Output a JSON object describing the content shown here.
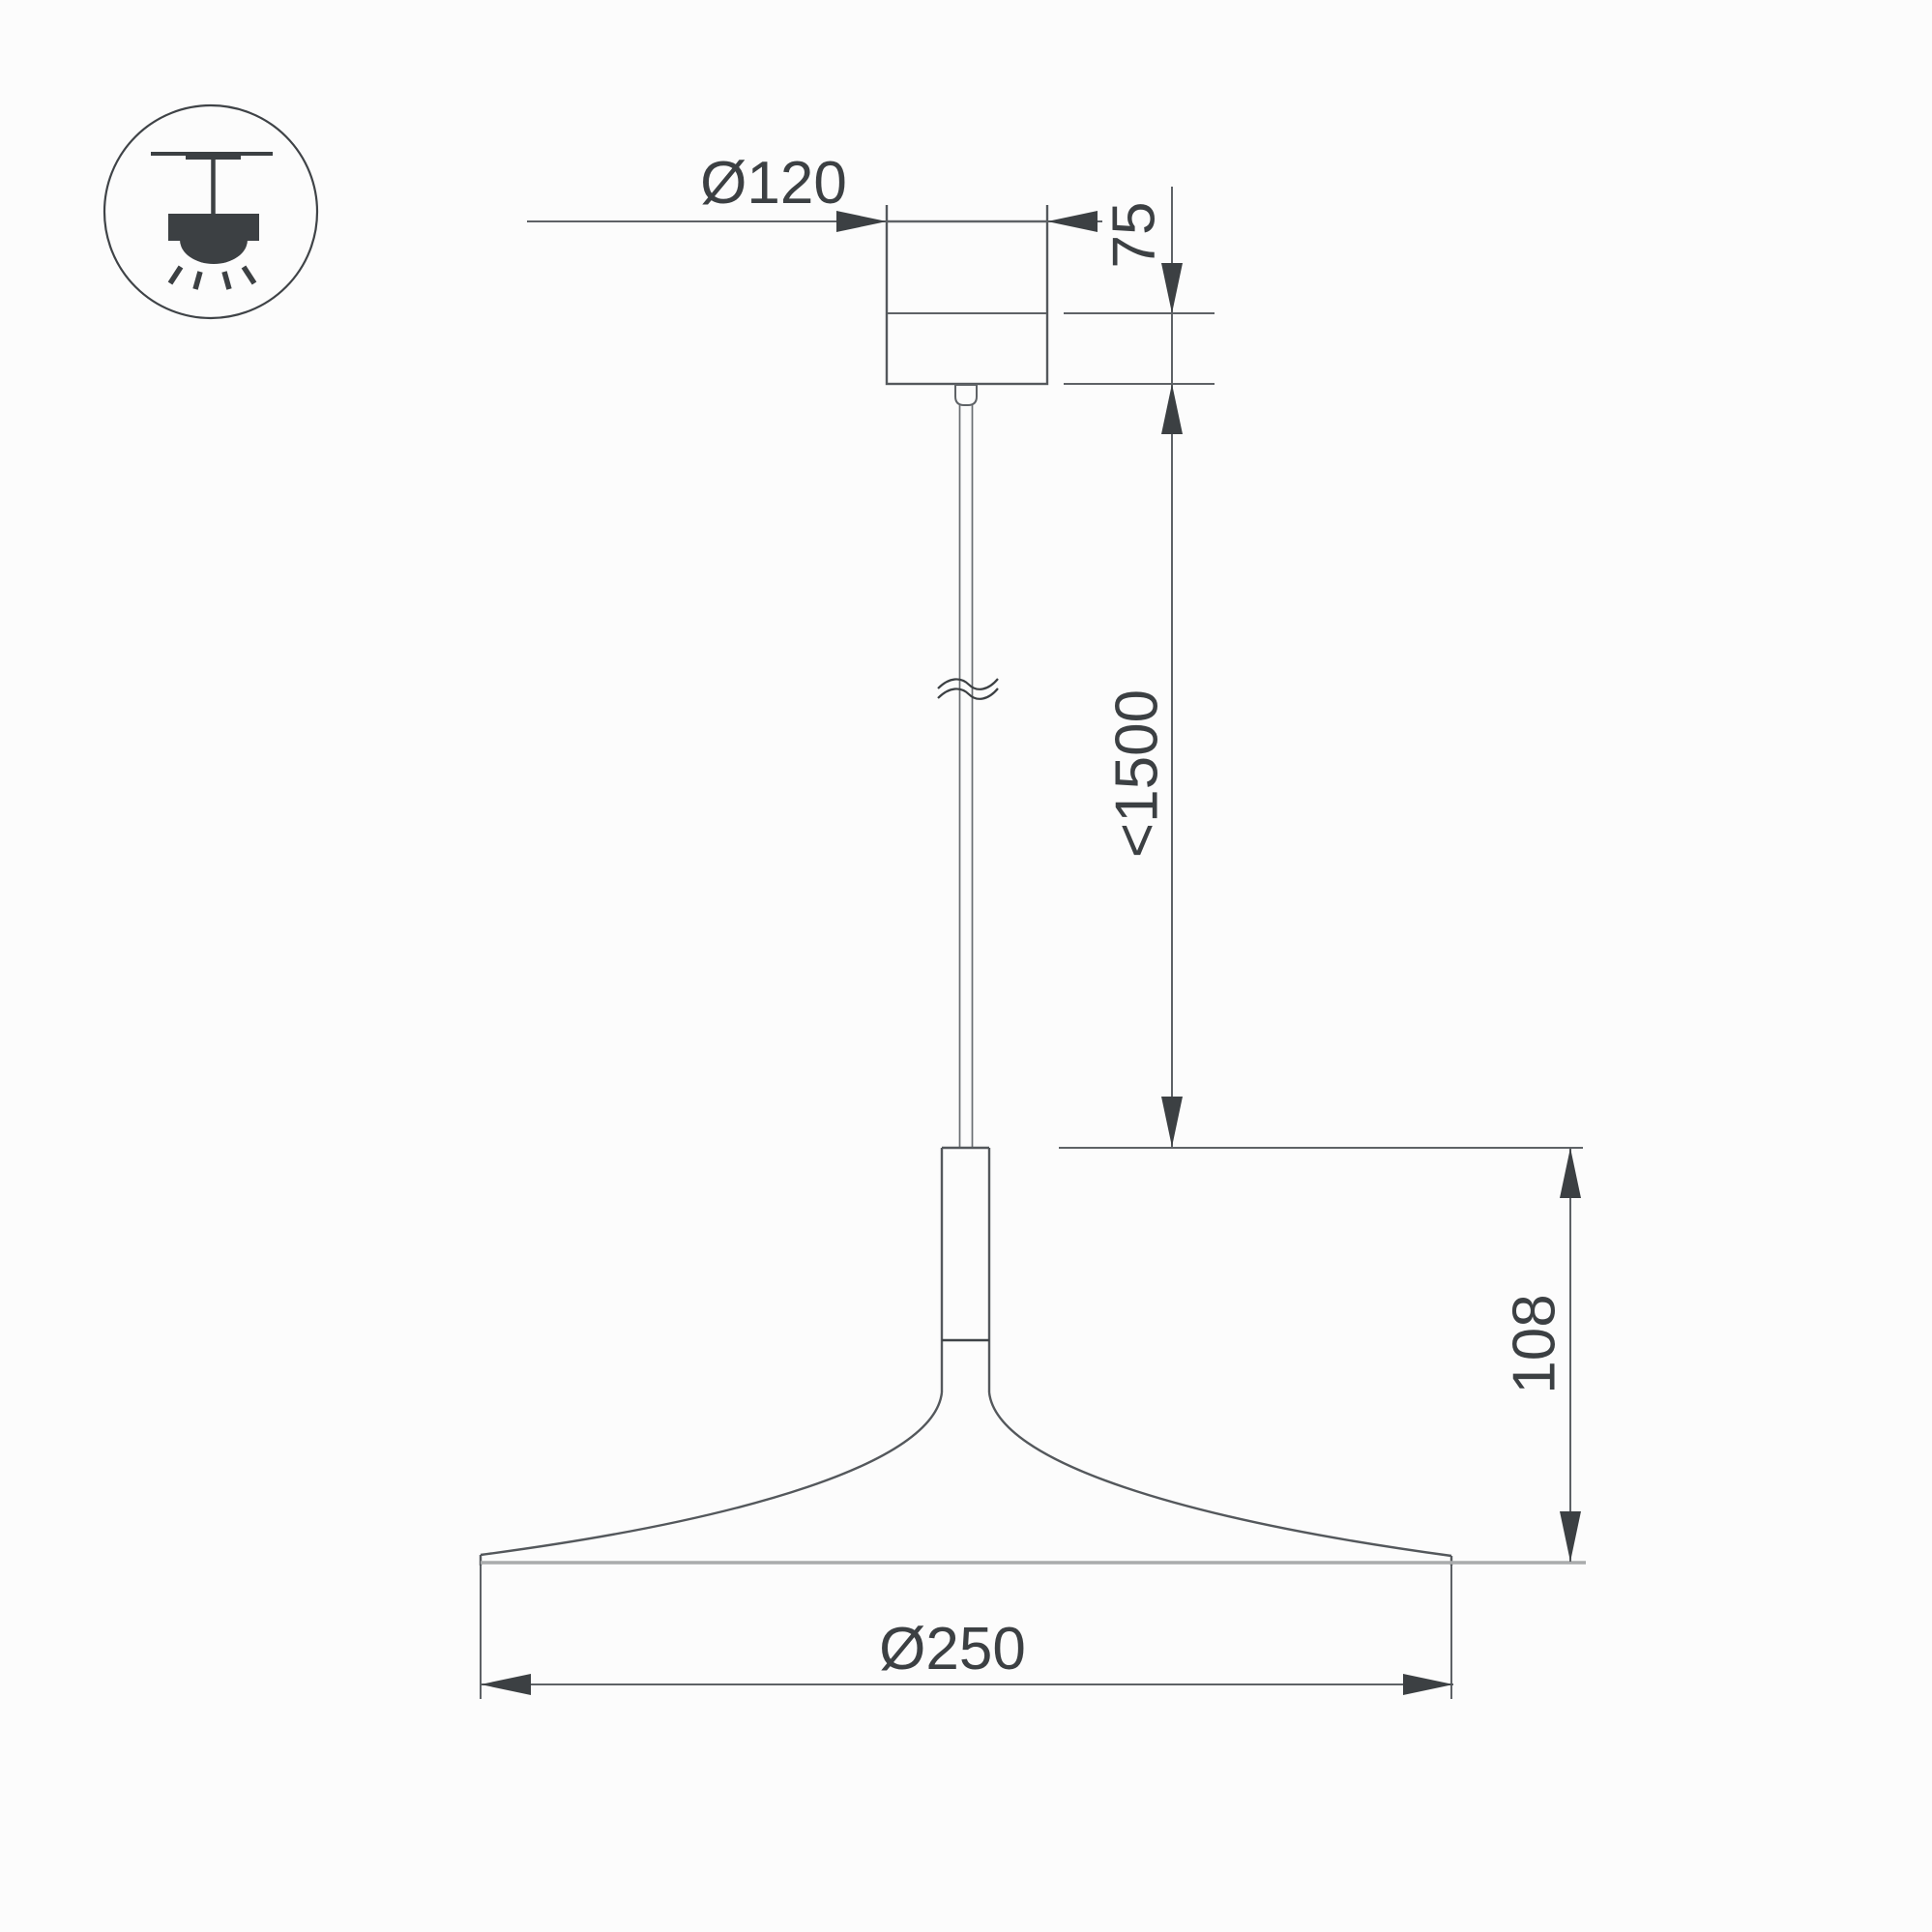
{
  "title": "Pendant luminaire dimensional drawing",
  "dimensions": {
    "canopy_diameter": "Ø120",
    "canopy_height": "75",
    "suspension_length": "<1500",
    "shade_height": "108",
    "shade_diameter": "Ø250"
  },
  "icon": {
    "name": "pendant-ceiling-mount-icon"
  },
  "colors": {
    "background": "#fcfcfc",
    "outline": "#54585c",
    "dimension_line": "#5e6266",
    "text_and_arrows": "#3c4043",
    "light_edge": "#a9abac"
  }
}
